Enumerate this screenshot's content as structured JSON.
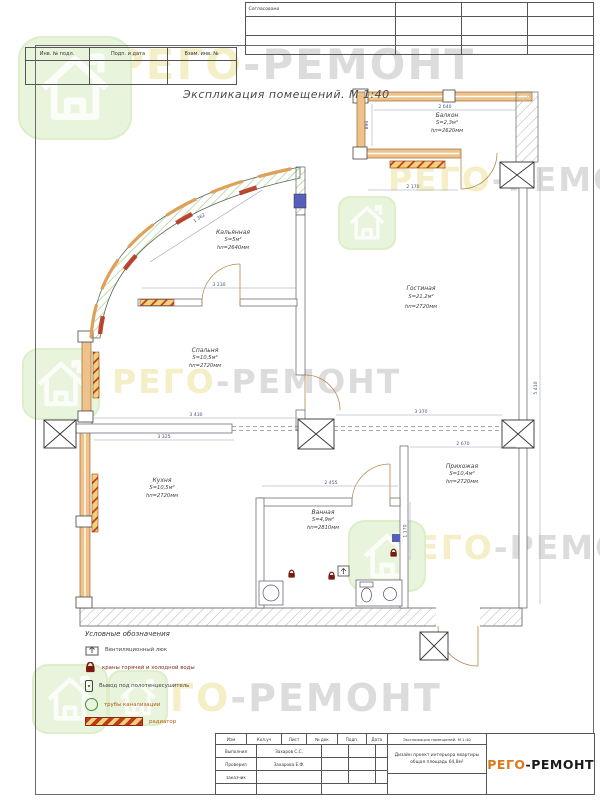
{
  "colors": {
    "brand_orange": "#e07818",
    "brand_dark": "#1a1a1a",
    "wall_orange": "#eec28a",
    "watermark_yellow": "#f4efc6",
    "watermark_gray": "#dcdcdc",
    "badge_green": "#e9f4dd",
    "radiator_red": "#bf3a1d"
  },
  "frame": {
    "stamp_label": "Согласовано",
    "left_cells": [
      "Инв. № подл.",
      "Подп. и дата",
      "Взам. инв. №"
    ]
  },
  "drawing": {
    "title": "Экспликация помещений. М 1:40"
  },
  "watermark": {
    "left": "РЕГО",
    "right": "-РЕМОНТ"
  },
  "rooms": [
    {
      "name": "Балкон",
      "area": "S=2,3м²",
      "height": "hп=2620мм"
    },
    {
      "name": "Кальянная",
      "area": "S=5м²",
      "height": "hп=2640мм"
    },
    {
      "name": "Гостиная",
      "area": "S=21,2м²",
      "height": "hп=2720мм"
    },
    {
      "name": "Спальня",
      "area": "S=10,5м²",
      "height": "hп=2720мм"
    },
    {
      "name": "Кухня",
      "area": "S=10,5м²",
      "height": "hп=2720мм"
    },
    {
      "name": "Ванная",
      "area": "S=4,9м²",
      "height": "hп=2810мм"
    },
    {
      "name": "Прихожая",
      "area": "S=10,4м²",
      "height": "hп=2720мм"
    }
  ],
  "dims": [
    "2 640",
    "890",
    "2 170",
    "1 362",
    "3 230",
    "3 430",
    "3 370",
    "3 325",
    "2 455",
    "1 170",
    "5 410",
    "2 670"
  ],
  "legend": {
    "title": "Условные обозначения",
    "items": [
      {
        "label": "Вентиляционный люк"
      },
      {
        "label": "краны горячей и холодной воды"
      },
      {
        "label": "Вывод под полотенцесушитель"
      },
      {
        "label": "трубы канализации"
      },
      {
        "label": "радиатор"
      }
    ]
  },
  "titleblock": {
    "cols": [
      "Изм",
      "Кол.уч",
      "Лист",
      "№ док",
      "Подп.",
      "Дата"
    ],
    "rows": [
      {
        "role": "Выполнил",
        "name": "Захаров С.С."
      },
      {
        "role": "Проверил",
        "name": "Захарова Е.Ф."
      },
      {
        "role": "заказчик",
        "name": ""
      }
    ],
    "doc_title": "Экспликация помещений. М 1:40",
    "project_line1": "Дизайн проект интерьера квартиры",
    "project_line2": "общая площадь 64,8м²",
    "brand_left": "РЕГО",
    "brand_right": "-РЕМОНТ"
  }
}
